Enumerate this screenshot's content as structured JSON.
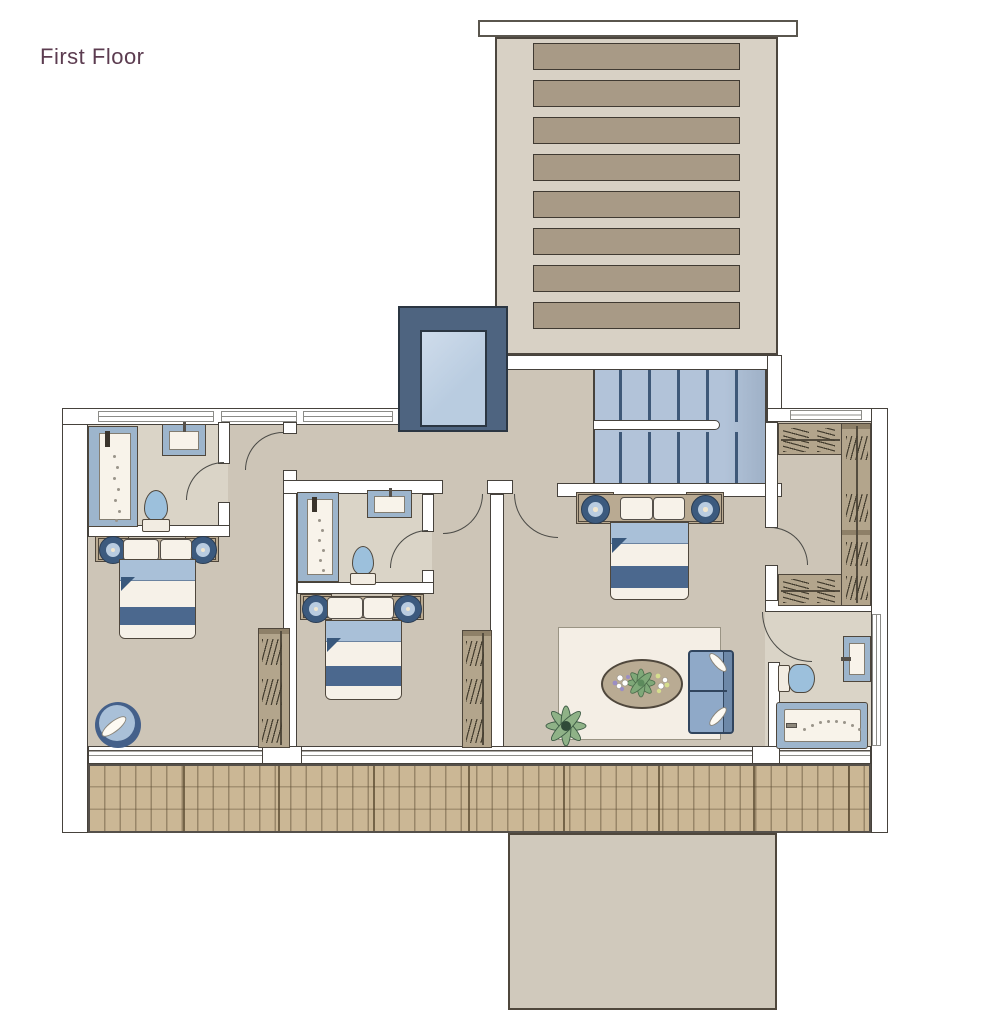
{
  "title": "First Floor",
  "palette": {
    "title-color": "#5c3c50",
    "wall-stroke": "#46423c",
    "floor": "#cdc5b7",
    "bath-floor": "#dad4c7",
    "roof-body": "#d8d1c5",
    "roof-slat": "#a89a86",
    "elevator-frame": "#4e6480",
    "elevator-car": "#b9cce0",
    "stairs-bg": "#b2c3d9",
    "stairs-line": "#3e5878",
    "bed-head": "#b9aa92",
    "blanket": "#a9c0d8",
    "stripe": "#4b688e",
    "linen": "#f6f1e8",
    "fixture-frame": "#9db5cc",
    "toilet-blue": "#9cc0dc",
    "wardrobe": "#b3a58c",
    "rug": "#f4eee5",
    "sofa": "#8fa9c8",
    "sofa-frame": "#31455e",
    "deck": "#cbb795",
    "annex": "#d0c9bc",
    "plant-green": "#8fb287"
  }
}
